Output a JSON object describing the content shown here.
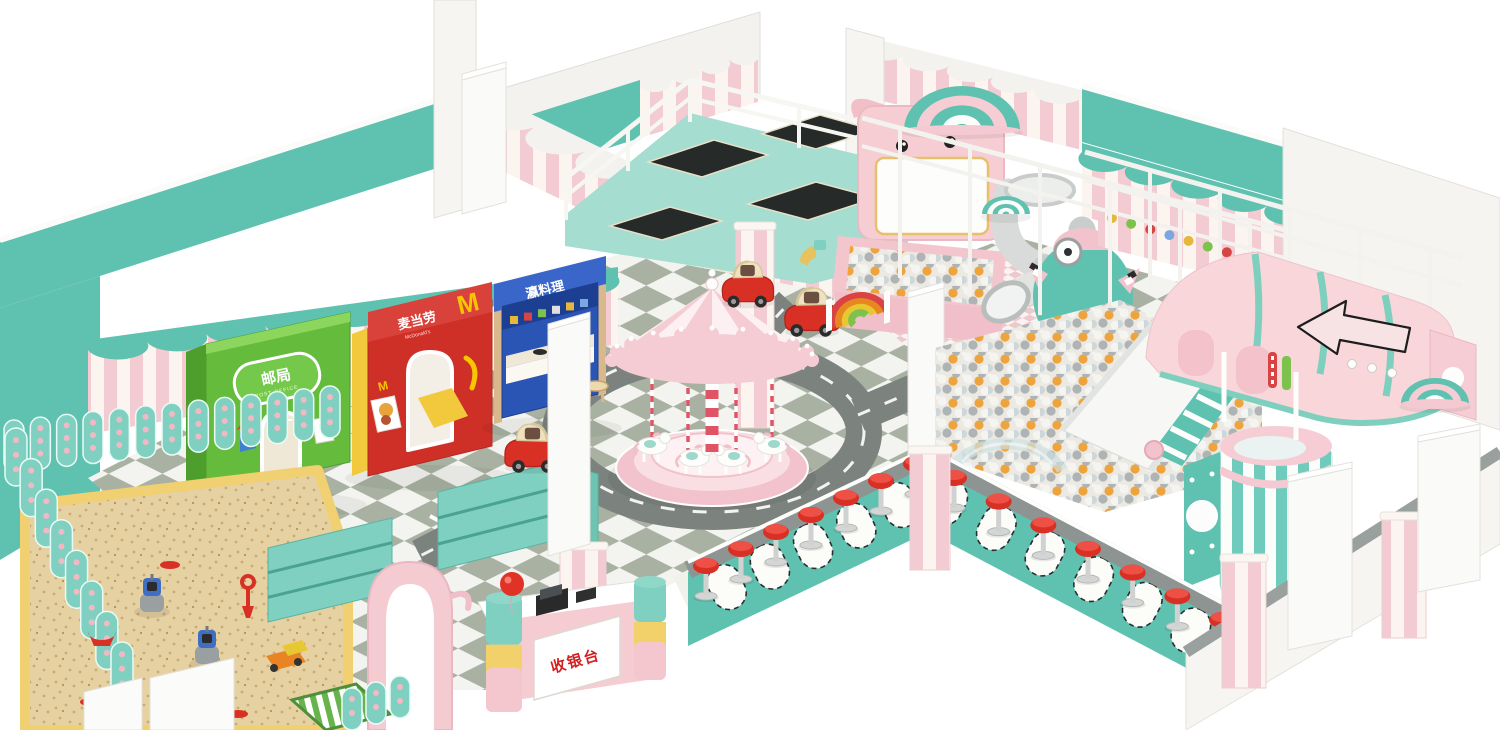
{
  "scene": {
    "background": "#ffffff"
  },
  "signs": {
    "post_office": {
      "cn": "邮局",
      "en": "POST OFFICE"
    },
    "mcdonalds": {
      "cn": "麦当劳",
      "en": "McDonald's",
      "logo": "M"
    },
    "japanese": {
      "cn": "瀛料理",
      "en": "Japanese Food"
    },
    "cashier": {
      "cn": "收银台"
    }
  },
  "palette": {
    "teal": "#5fc2b0",
    "tealDark": "#46a896",
    "tealShelf": "#7fd0c0",
    "deck": "#a5ddd0",
    "pink": "#f4c6ce",
    "pinkSoft": "#f8d6da",
    "pinkDeep": "#eeb3bf",
    "stripePink": "#f2ccd2",
    "cream": "#f0e8d6",
    "white": "#ffffff",
    "wallWhite": "#f3f2ee",
    "red": "#d93025",
    "redDark": "#b3251c",
    "green": "#64bb3c",
    "greenDark": "#4d9e2d",
    "mcdRed": "#ce3027",
    "mcdDark": "#b52a22",
    "yellow": "#f2c93c",
    "gold": "#f7c600",
    "blue": "#2b55b5",
    "blueDark": "#1d3f92",
    "wood": "#d9b98c",
    "sand": "#e6d1a2",
    "sandDot": "#c9ab74",
    "tileLight": "#f3f4ef",
    "tileDark": "#a9b1a3",
    "road": "#7c837e",
    "edge": "#8d9492",
    "ballWhite": "#f4f4f1",
    "ballGray": "#aeb4b6",
    "ballOrange": "#eea43c",
    "ballBlue": "#cdd7d9",
    "slideWhite": "#f7f8f6",
    "grayTube": "#d5d8d6",
    "dark": "#2b2b2b"
  }
}
